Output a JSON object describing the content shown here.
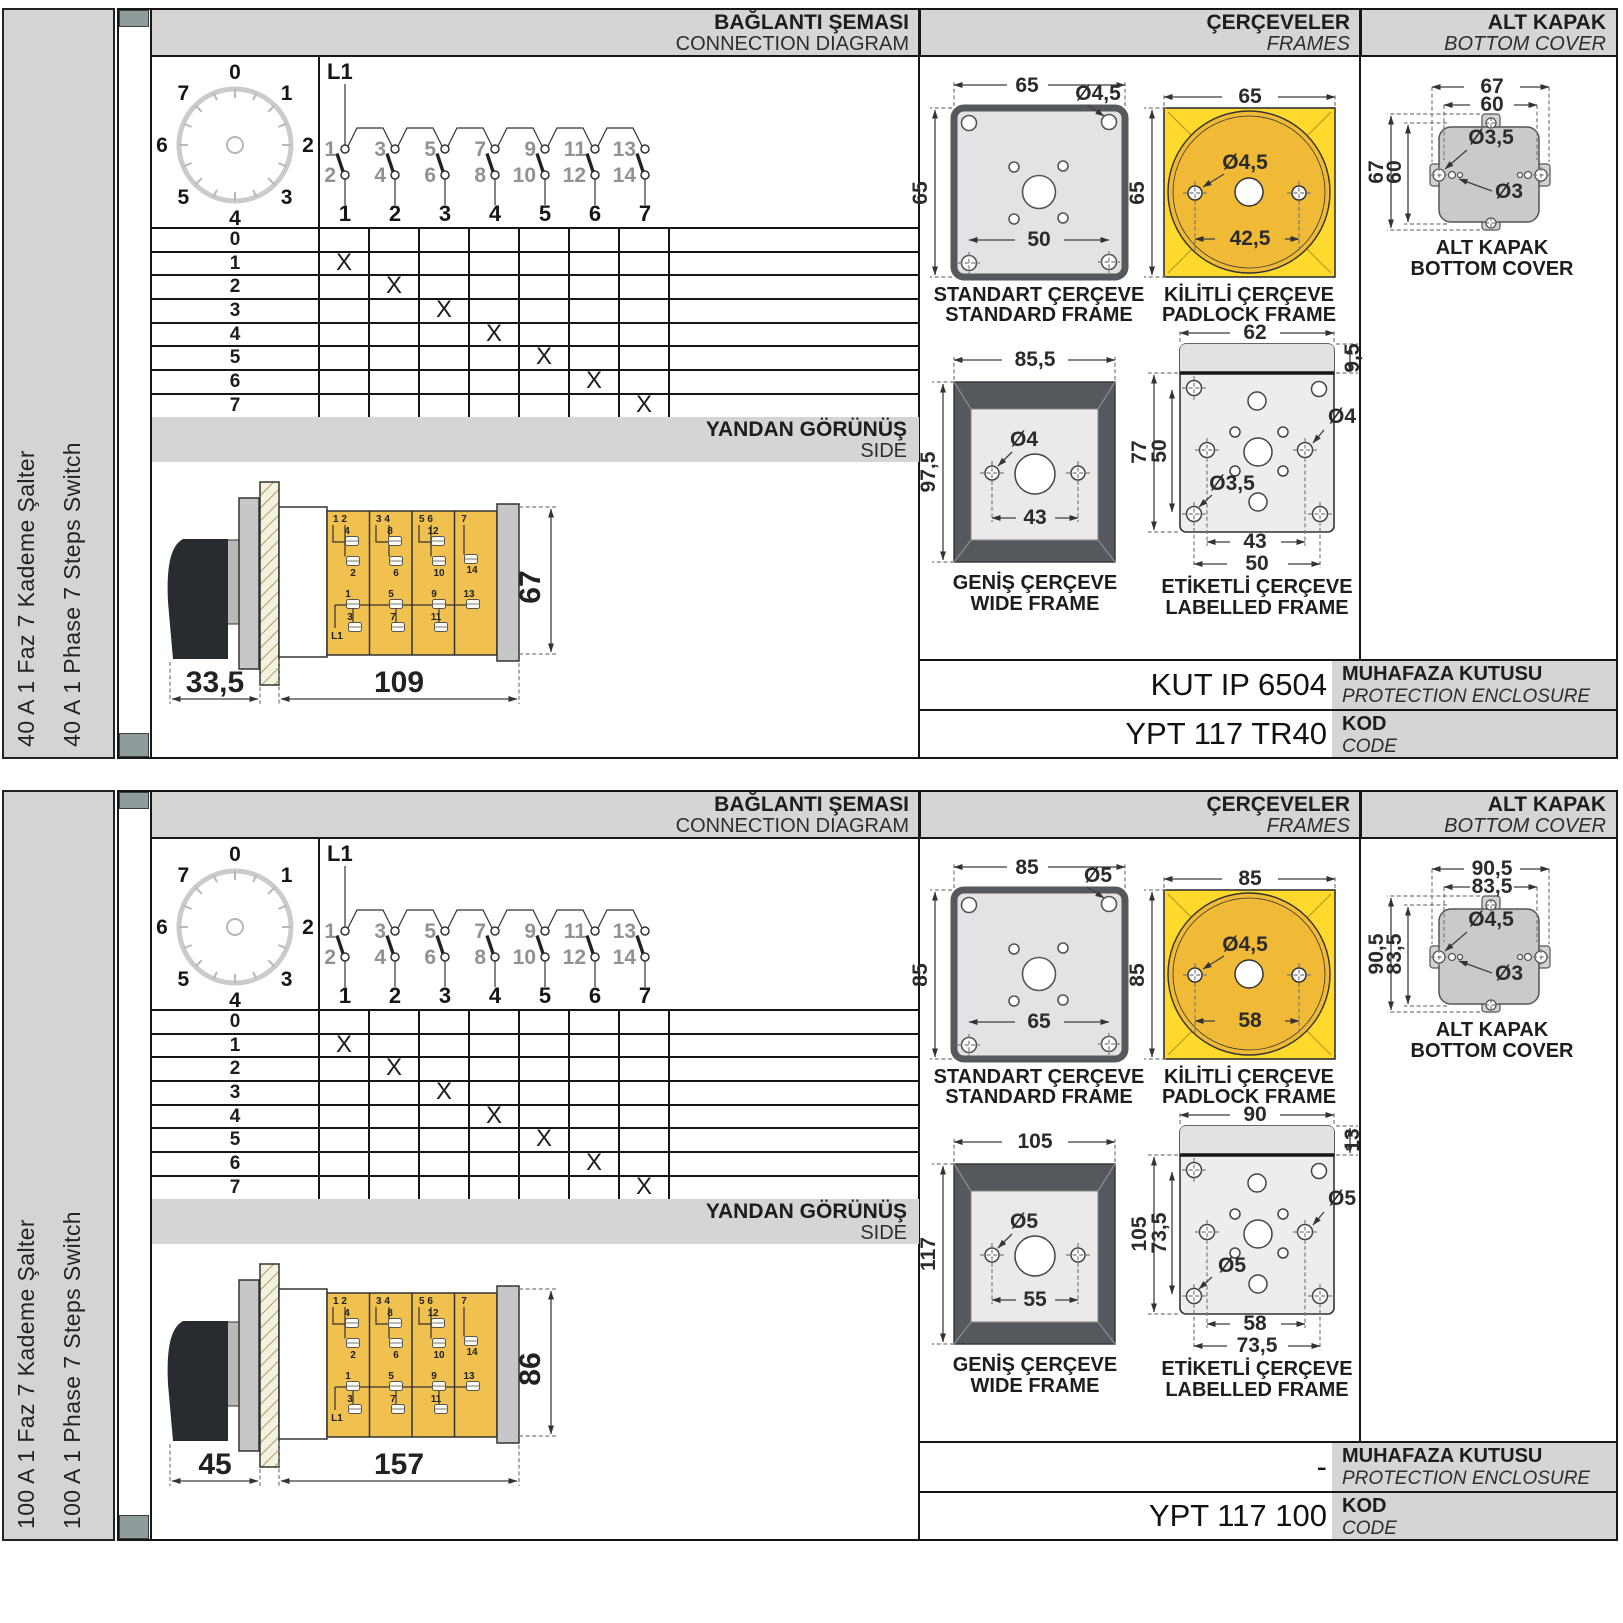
{
  "panels": [
    {
      "sidebar": {
        "title_tr": "40 A 1 Faz 7 Kademe Şalter",
        "title_en": "40 A 1 Phase 7 Steps Switch"
      },
      "header": {
        "conn_tr": "BAĞLANTI ŞEMASI",
        "conn_en": "CONNECTION DIAGRAM",
        "frames_tr": "ÇERÇEVELER",
        "frames_en": "FRAMES",
        "cover_tr": "ALT KAPAK",
        "cover_en": "BOTTOM COVER"
      },
      "dial": {
        "positions": [
          "0",
          "1",
          "2",
          "3",
          "4",
          "5",
          "6",
          "7"
        ]
      },
      "contacts": {
        "supply": "L1",
        "top": [
          "1",
          "3",
          "5",
          "7",
          "9",
          "11",
          "13"
        ],
        "bottom": [
          "2",
          "4",
          "6",
          "8",
          "10",
          "12",
          "14"
        ],
        "poles": [
          "1",
          "2",
          "3",
          "4",
          "5",
          "6",
          "7"
        ]
      },
      "table": {
        "rows": [
          {
            "label": "0",
            "x": 0
          },
          {
            "label": "1",
            "x": 1
          },
          {
            "label": "2",
            "x": 2
          },
          {
            "label": "3",
            "x": 3
          },
          {
            "label": "4",
            "x": 4
          },
          {
            "label": "5",
            "x": 5
          },
          {
            "label": "6",
            "x": 6
          },
          {
            "label": "7",
            "x": 7
          }
        ]
      },
      "side_view": {
        "title_tr": "YANDAN GÖRÜNÜŞ",
        "title_en": "SIDE",
        "supply": "L1",
        "dim_depth": "33,5",
        "dim_length": "109",
        "dim_height": "67",
        "sections": [
          {
            "pair": "1  2",
            "u1": "4",
            "u2": "2",
            "l1": "1",
            "l2": "3"
          },
          {
            "pair": "3  4",
            "u1": "8",
            "u2": "6",
            "l1": "5",
            "l2": "7"
          },
          {
            "pair": "5  6",
            "u1": "12",
            "u2": "10",
            "l1": "9",
            "l2": "11"
          },
          {
            "pair": "7",
            "u1": "14",
            "l1": "13"
          }
        ]
      },
      "frames": {
        "standard": {
          "title_tr": "STANDART ÇERÇEVE",
          "title_en": "STANDARD FRAME",
          "w": "65",
          "h": "65",
          "hole": "Ø4,5",
          "pitch": "50"
        },
        "padlock": {
          "title_tr": "KİLİTLİ ÇERÇEVE",
          "title_en": "PADLOCK FRAME",
          "w": "65",
          "h": "65",
          "hole": "Ø4,5",
          "pitch": "42,5"
        },
        "wide": {
          "title_tr": "GENİŞ ÇERÇEVE",
          "title_en": "WIDE FRAME",
          "w": "85,5",
          "h": "97,5",
          "hole": "Ø4",
          "pitch": "43"
        },
        "labelled": {
          "title_tr": "ETİKETLİ ÇERÇEVE",
          "title_en": "LABELLED FRAME",
          "w": "62",
          "strip": "9,5",
          "h": "77",
          "h2": "50",
          "hole_right": "Ø4",
          "hole_inner": "Ø3,5",
          "pitch1": "43",
          "pitch2": "50"
        }
      },
      "cover": {
        "title_tr": "ALT KAPAK",
        "title_en": "BOTTOM COVER",
        "w1": "67",
        "w2": "60",
        "h1": "67",
        "h2": "60",
        "hole1": "Ø3,5",
        "hole2": "Ø3"
      },
      "enclosure": {
        "value": "KUT IP 6504",
        "label_tr": "MUHAFAZA KUTUSU",
        "label_en": "PROTECTION ENCLOSURE"
      },
      "code": {
        "value": "YPT 117 TR40",
        "label_tr": "KOD",
        "label_en": "CODE"
      }
    },
    {
      "sidebar": {
        "title_tr": "100 A 1 Faz 7 Kademe Şalter",
        "title_en": "100 A 1 Phase 7 Steps Switch"
      },
      "header": {
        "conn_tr": "BAĞLANTI ŞEMASI",
        "conn_en": "CONNECTION DIAGRAM",
        "frames_tr": "ÇERÇEVELER",
        "frames_en": "FRAMES",
        "cover_tr": "ALT KAPAK",
        "cover_en": "BOTTOM COVER"
      },
      "dial": {
        "positions": [
          "0",
          "1",
          "2",
          "3",
          "4",
          "5",
          "6",
          "7"
        ]
      },
      "contacts": {
        "supply": "L1",
        "top": [
          "1",
          "3",
          "5",
          "7",
          "9",
          "11",
          "13"
        ],
        "bottom": [
          "2",
          "4",
          "6",
          "8",
          "10",
          "12",
          "14"
        ],
        "poles": [
          "1",
          "2",
          "3",
          "4",
          "5",
          "6",
          "7"
        ]
      },
      "table": {
        "rows": [
          {
            "label": "0",
            "x": 0
          },
          {
            "label": "1",
            "x": 1
          },
          {
            "label": "2",
            "x": 2
          },
          {
            "label": "3",
            "x": 3
          },
          {
            "label": "4",
            "x": 4
          },
          {
            "label": "5",
            "x": 5
          },
          {
            "label": "6",
            "x": 6
          },
          {
            "label": "7",
            "x": 7
          }
        ]
      },
      "side_view": {
        "title_tr": "YANDAN GÖRÜNÜŞ",
        "title_en": "SIDE",
        "supply": "L1",
        "dim_depth": "45",
        "dim_length": "157",
        "dim_height": "86",
        "sections": [
          {
            "pair": "1  2",
            "u1": "4",
            "u2": "2",
            "l1": "1",
            "l2": "3"
          },
          {
            "pair": "3  4",
            "u1": "8",
            "u2": "6",
            "l1": "5",
            "l2": "7"
          },
          {
            "pair": "5  6",
            "u1": "12",
            "u2": "10",
            "l1": "9",
            "l2": "11"
          },
          {
            "pair": "7",
            "u1": "14",
            "l1": "13"
          }
        ]
      },
      "frames": {
        "standard": {
          "title_tr": "STANDART ÇERÇEVE",
          "title_en": "STANDARD FRAME",
          "w": "85",
          "h": "85",
          "hole": "Ø5",
          "pitch": "65"
        },
        "padlock": {
          "title_tr": "KİLİTLİ ÇERÇEVE",
          "title_en": "PADLOCK FRAME",
          "w": "85",
          "h": "85",
          "hole": "Ø4,5",
          "pitch": "58"
        },
        "wide": {
          "title_tr": "GENİŞ ÇERÇEVE",
          "title_en": "WIDE FRAME",
          "w": "105",
          "h": "117",
          "hole": "Ø5",
          "pitch": "55"
        },
        "labelled": {
          "title_tr": "ETİKETLİ ÇERÇEVE",
          "title_en": "LABELLED FRAME",
          "w": "90",
          "strip": "13",
          "h": "105",
          "h2": "73,5",
          "hole_right": "Ø5",
          "hole_inner": "Ø5",
          "pitch1": "58",
          "pitch2": "73,5"
        }
      },
      "cover": {
        "title_tr": "ALT KAPAK",
        "title_en": "BOTTOM COVER",
        "w1": "90,5",
        "w2": "83,5",
        "h1": "90,5",
        "h2": "83,5",
        "hole1": "Ø4,5",
        "hole2": "Ø3"
      },
      "enclosure": {
        "value": "-",
        "label_tr": "MUHAFAZA KUTUSU",
        "label_en": "PROTECTION ENCLOSURE"
      },
      "code": {
        "value": "YPT 117 100",
        "label_tr": "KOD",
        "label_en": "CODE"
      }
    }
  ]
}
